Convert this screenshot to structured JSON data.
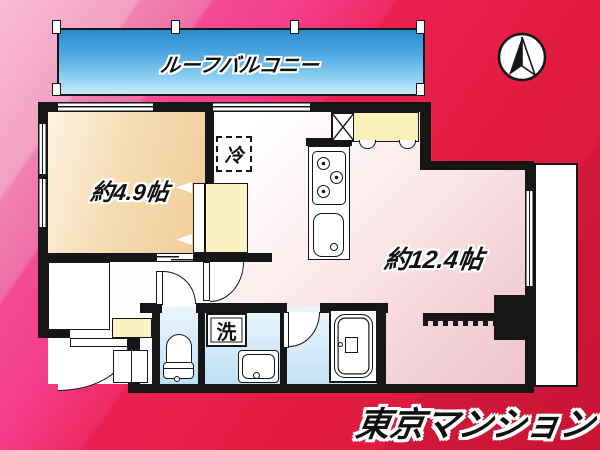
{
  "plan": {
    "roof_balcony_label": "ルーフバルコニー",
    "west_room_label": "約4.9帖",
    "living_room_label": "約12.4帖",
    "refrigerator_label": "冷",
    "washer_label": "洗",
    "brand_label": "東京マンション"
  },
  "icons": {
    "compass": "north-arrow-icon"
  },
  "colors": {
    "wall": "#161616",
    "bg_pink_light": "#f5abc9",
    "bg_pink_hot": "#f43e8c",
    "bg_red": "#e71f47",
    "balcony_blue_top": "#2a8ccd",
    "balcony_blue_bottom": "#cdeafa",
    "room_beige": "#f1cf9e",
    "floor_pink": "#f2ccd4",
    "wet_blue": "#bfdff4",
    "closet_yellow": "#faf2c2"
  }
}
